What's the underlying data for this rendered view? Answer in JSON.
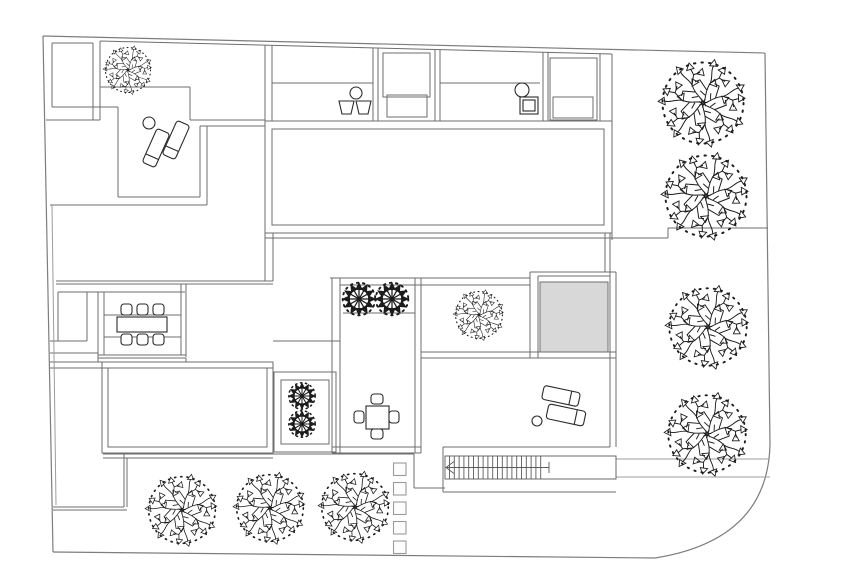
{
  "meta": {
    "type": "architectural-site-plan",
    "canvas": {
      "w": 860,
      "h": 573,
      "background": "#ffffff"
    }
  },
  "palette": {
    "boundary": "#7d7d7d",
    "wall": "#6e6e6e",
    "light": "#9c9c9c",
    "furniture": "#2a2a2a",
    "tree": "#1c1c1c",
    "gray_fill": "#d8d8d8",
    "stone_fill": "#fcfcfc",
    "stone_stroke": "#9a9a9a",
    "white": "#ffffff"
  },
  "boundary": {
    "outline": [
      "M43,36 L765,53",
      "M765,53 L770,444",
      "M770,444 Q768,540 655,558",
      "M655,558 L53,552",
      "M43,36 L53,552"
    ]
  },
  "walls": [
    [
      52,
      43,
      93,
      43
    ],
    [
      52,
      43,
      52,
      107
    ],
    [
      52,
      107,
      118,
      107
    ],
    [
      93,
      43,
      93,
      120
    ],
    [
      100,
      41,
      100,
      120
    ],
    [
      46,
      120,
      100,
      120
    ],
    [
      100,
      41,
      612,
      54
    ],
    [
      265,
      45,
      265,
      121
    ],
    [
      272,
      45,
      272,
      121
    ],
    [
      373,
      48,
      373,
      121
    ],
    [
      378,
      48,
      378,
      121
    ],
    [
      435,
      49,
      435,
      121
    ],
    [
      440,
      50,
      440,
      121
    ],
    [
      543,
      52,
      543,
      121
    ],
    [
      548,
      52,
      548,
      121
    ],
    [
      600,
      54,
      600,
      121
    ],
    [
      612,
      54,
      612,
      240
    ],
    [
      272,
      83,
      373,
      83
    ],
    [
      440,
      83,
      540,
      83
    ],
    [
      100,
      87,
      190,
      87
    ],
    [
      190,
      87,
      190,
      120
    ],
    [
      190,
      120,
      265,
      120
    ],
    [
      200,
      126,
      265,
      126
    ],
    [
      200,
      126,
      200,
      197
    ],
    [
      207,
      126,
      207,
      205
    ],
    [
      118,
      197,
      200,
      197
    ],
    [
      50,
      205,
      207,
      205
    ],
    [
      118,
      107,
      118,
      197
    ],
    [
      265,
      238,
      668,
      238
    ],
    [
      668,
      228,
      668,
      238
    ],
    [
      668,
      228,
      768,
      228
    ],
    [
      265,
      233,
      265,
      281
    ],
    [
      273,
      233,
      273,
      281
    ],
    [
      56,
      281,
      273,
      281
    ],
    [
      56,
      284,
      273,
      284
    ],
    [
      58,
      292,
      58,
      341
    ],
    [
      87,
      292,
      87,
      341
    ],
    [
      58,
      292,
      185,
      292
    ],
    [
      50,
      341,
      87,
      341
    ],
    [
      50,
      353,
      98,
      353
    ],
    [
      98,
      292,
      98,
      362
    ],
    [
      104,
      292,
      104,
      355
    ],
    [
      181,
      284,
      181,
      355
    ],
    [
      186,
      284,
      186,
      357
    ],
    [
      98,
      355,
      186,
      355
    ],
    [
      98,
      358,
      186,
      358
    ],
    [
      186,
      358,
      186,
      362
    ],
    [
      50,
      362,
      273,
      362
    ],
    [
      50,
      368,
      273,
      368
    ],
    [
      103,
      454,
      414,
      454
    ],
    [
      103,
      458,
      273,
      458
    ],
    [
      414,
      454,
      414,
      488
    ],
    [
      414,
      488,
      445,
      488
    ],
    [
      124,
      454,
      124,
      507
    ],
    [
      127,
      458,
      127,
      507
    ],
    [
      53,
      507,
      124,
      507
    ],
    [
      53,
      510,
      127,
      510
    ],
    [
      330,
      278,
      530,
      278
    ],
    [
      340,
      285,
      530,
      285
    ],
    [
      332,
      278,
      332,
      453
    ],
    [
      340,
      278,
      340,
      453
    ],
    [
      415,
      278,
      415,
      453
    ],
    [
      421,
      278,
      421,
      453
    ],
    [
      343,
      313,
      415,
      313
    ],
    [
      332,
      447,
      421,
      447
    ],
    [
      332,
      453,
      421,
      453
    ],
    [
      530,
      272,
      616,
      272
    ],
    [
      538,
      276,
      610,
      276
    ],
    [
      530,
      272,
      530,
      358
    ],
    [
      538,
      276,
      538,
      358
    ],
    [
      605,
      233,
      605,
      272
    ],
    [
      610,
      233,
      610,
      272
    ],
    [
      421,
      352,
      616,
      352
    ],
    [
      421,
      358,
      616,
      358
    ],
    [
      610,
      272,
      610,
      447
    ],
    [
      616,
      272,
      616,
      447
    ],
    [
      443,
      447,
      610,
      447
    ],
    [
      443,
      447,
      443,
      492
    ],
    [
      443,
      492,
      616,
      492
    ],
    [
      273,
      341,
      340,
      341
    ]
  ],
  "light_lines": [
    [
      616,
      459,
      769,
      459
    ],
    [
      616,
      477,
      770,
      477
    ],
    [
      52,
      205,
      56,
      505
    ]
  ],
  "rects": [
    {
      "name": "pool-outer",
      "x": 265,
      "y": 121,
      "w": 347,
      "h": 112
    },
    {
      "name": "pool-inner",
      "x": 272,
      "y": 129,
      "w": 332,
      "h": 96
    },
    {
      "name": "storage-unit-a",
      "x": 383,
      "y": 53,
      "w": 47,
      "h": 44
    },
    {
      "name": "storage-unit-a2",
      "x": 387,
      "y": 95,
      "w": 40,
      "h": 22
    },
    {
      "name": "storage-unit-b",
      "x": 550,
      "y": 58,
      "w": 47,
      "h": 62
    },
    {
      "name": "storage-unit-b2",
      "x": 553,
      "y": 97,
      "w": 40,
      "h": 21
    },
    {
      "name": "living-room-outer",
      "x": 102,
      "y": 362,
      "w": 171,
      "h": 91
    },
    {
      "name": "living-room-inner",
      "x": 108,
      "y": 368,
      "w": 159,
      "h": 79
    },
    {
      "name": "planter-room-outer",
      "x": 274,
      "y": 372,
      "w": 62,
      "h": 80
    },
    {
      "name": "planter-room-inner",
      "x": 281,
      "y": 380,
      "w": 48,
      "h": 64
    }
  ],
  "gray_pad": {
    "x": 540,
    "y": 282,
    "w": 68,
    "h": 70
  },
  "stairs": {
    "outer": {
      "x": 445,
      "y": 456,
      "w": 171,
      "h": 23
    },
    "tread_x0": 449.5,
    "tread_dx": 4.8,
    "tread_n": 20,
    "tread_y0": 456,
    "tread_y1": 479,
    "center_y": 467.5,
    "center_x0": 446,
    "center_x1": 549,
    "arrow": "M454,461.5 L446,467.5 L454,473.5",
    "tick": [
      549,
      462,
      549,
      473
    ]
  },
  "stepping_stones": {
    "size": 12.5,
    "x": 393.5,
    "ys": [
      463,
      482.5,
      502,
      521.5,
      541
    ]
  },
  "trees": {
    "large": [
      {
        "cx": 128,
        "cy": 70,
        "s": 0.5
      },
      {
        "cx": 703,
        "cy": 103,
        "s": 0.9
      },
      {
        "cx": 706,
        "cy": 196,
        "s": 0.9
      },
      {
        "cx": 708,
        "cy": 327,
        "s": 0.86
      },
      {
        "cx": 707,
        "cy": 434,
        "s": 0.86
      },
      {
        "cx": 182,
        "cy": 510,
        "s": 0.74
      },
      {
        "cx": 270,
        "cy": 508,
        "s": 0.74
      },
      {
        "cx": 355,
        "cy": 507,
        "s": 0.74
      },
      {
        "cx": 479,
        "cy": 315,
        "s": 0.52
      }
    ],
    "shrubs": [
      {
        "cx": 359,
        "cy": 299,
        "s": 1.05
      },
      {
        "cx": 392,
        "cy": 299,
        "s": 1.05
      },
      {
        "cx": 302,
        "cy": 396,
        "s": 0.85
      },
      {
        "cx": 302,
        "cy": 424,
        "s": 0.85
      }
    ]
  },
  "furniture": {
    "loungers": [
      {
        "cx": 156,
        "cy": 148,
        "w": 14,
        "h": 37,
        "rot": 24
      },
      {
        "cx": 176,
        "cy": 140,
        "w": 14,
        "h": 37,
        "rot": 24
      },
      {
        "cx": 561,
        "cy": 396,
        "w": 37,
        "h": 14,
        "rot": 12
      },
      {
        "cx": 566,
        "cy": 415,
        "w": 38,
        "h": 15,
        "rot": 12
      }
    ],
    "side_tables": [
      {
        "cx": 149,
        "cy": 123,
        "r": 6
      },
      {
        "cx": 537,
        "cy": 421,
        "r": 5
      }
    ],
    "dining_table": {
      "x": 117,
      "y": 317,
      "w": 50,
      "h": 15
    },
    "dining_chairs": [
      {
        "x": 121,
        "y": 304
      },
      {
        "x": 137,
        "y": 304
      },
      {
        "x": 153,
        "y": 304
      },
      {
        "x": 121,
        "y": 334
      },
      {
        "x": 137,
        "y": 334
      },
      {
        "x": 153,
        "y": 334
      }
    ],
    "platform_lines": [
      [
        104,
        315,
        181,
        315
      ],
      [
        104,
        337,
        181,
        337
      ]
    ],
    "square_table": {
      "x": 366,
      "y": 406,
      "w": 23,
      "h": 23
    },
    "square_chairs": [
      {
        "x": 371,
        "y": 394,
        "w": 12,
        "h": 10
      },
      {
        "x": 371,
        "y": 429,
        "w": 12,
        "h": 10
      },
      {
        "x": 354,
        "y": 411,
        "w": 10,
        "h": 12
      },
      {
        "x": 389,
        "y": 411,
        "w": 10,
        "h": 12
      }
    ],
    "pots": [
      "M339,101 L354,101 L351,114 L342,114 Z",
      "M356,101 L371,101 L368,114 L359,114 Z"
    ],
    "pot_circle": {
      "cx": 356,
      "cy": 93,
      "r": 6
    },
    "grill": {
      "circle": {
        "cx": 522,
        "cy": 90,
        "r": 7
      },
      "outer": {
        "x": 520,
        "y": 97,
        "w": 18,
        "h": 17
      },
      "inner": {
        "x": 523,
        "y": 100,
        "w": 12,
        "h": 11
      }
    }
  }
}
